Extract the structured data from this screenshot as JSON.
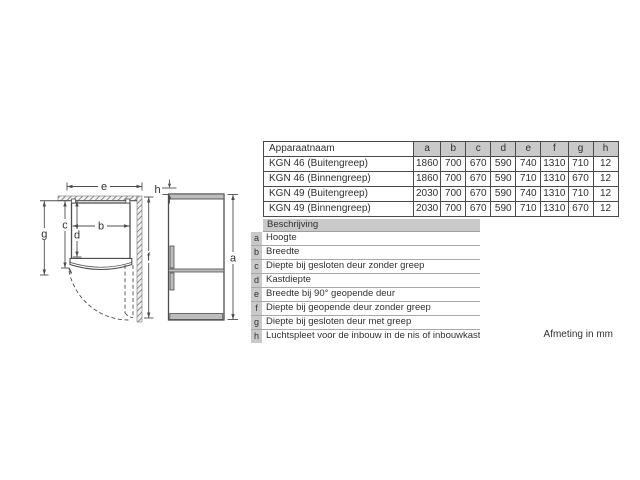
{
  "diagram": {
    "labels": {
      "a": "a",
      "b": "b",
      "c": "c",
      "d": "d",
      "e": "e",
      "f": "f",
      "g": "g",
      "h": "h"
    }
  },
  "table": {
    "header": [
      "Apparaatnaam",
      "a",
      "b",
      "c",
      "d",
      "e",
      "f",
      "g",
      "h"
    ],
    "rows": [
      [
        "KGN 46 (Buitengreep)",
        "1860",
        "700",
        "670",
        "590",
        "740",
        "1310",
        "710",
        "12"
      ],
      [
        "KGN 46 (Binnengreep)",
        "1860",
        "700",
        "670",
        "590",
        "710",
        "1310",
        "670",
        "12"
      ],
      [
        "KGN 49 (Buitengreep)",
        "2030",
        "700",
        "670",
        "590",
        "740",
        "1310",
        "710",
        "12"
      ],
      [
        "KGN 49 (Binnengreep)",
        "2030",
        "700",
        "670",
        "590",
        "710",
        "1310",
        "670",
        "12"
      ]
    ]
  },
  "legend": {
    "header": "Beschrijving",
    "items": [
      {
        "key": "a",
        "text": "Hoogte"
      },
      {
        "key": "b",
        "text": "Breedte"
      },
      {
        "key": "c",
        "text": "Diepte bij gesloten deur zonder greep"
      },
      {
        "key": "d",
        "text": "Kastdiepte"
      },
      {
        "key": "e",
        "text": "Breedte bij 90° geopende deur"
      },
      {
        "key": "f",
        "text": "Diepte bij geopende deur zonder greep"
      },
      {
        "key": "g",
        "text": "Diepte bij gesloten deur met greep"
      },
      {
        "key": "h",
        "text": "Luchtspleet voor de inbouw in de nis of inbouwkast"
      }
    ]
  },
  "footer": {
    "note": "Afmeting in mm"
  },
  "colors": {
    "header_bg": "#c9c9c9",
    "table_border": "#4a4a4a",
    "text": "#303030",
    "diagram_line": "#4d4d4d",
    "fridge_gray": "#bdbdbd"
  }
}
